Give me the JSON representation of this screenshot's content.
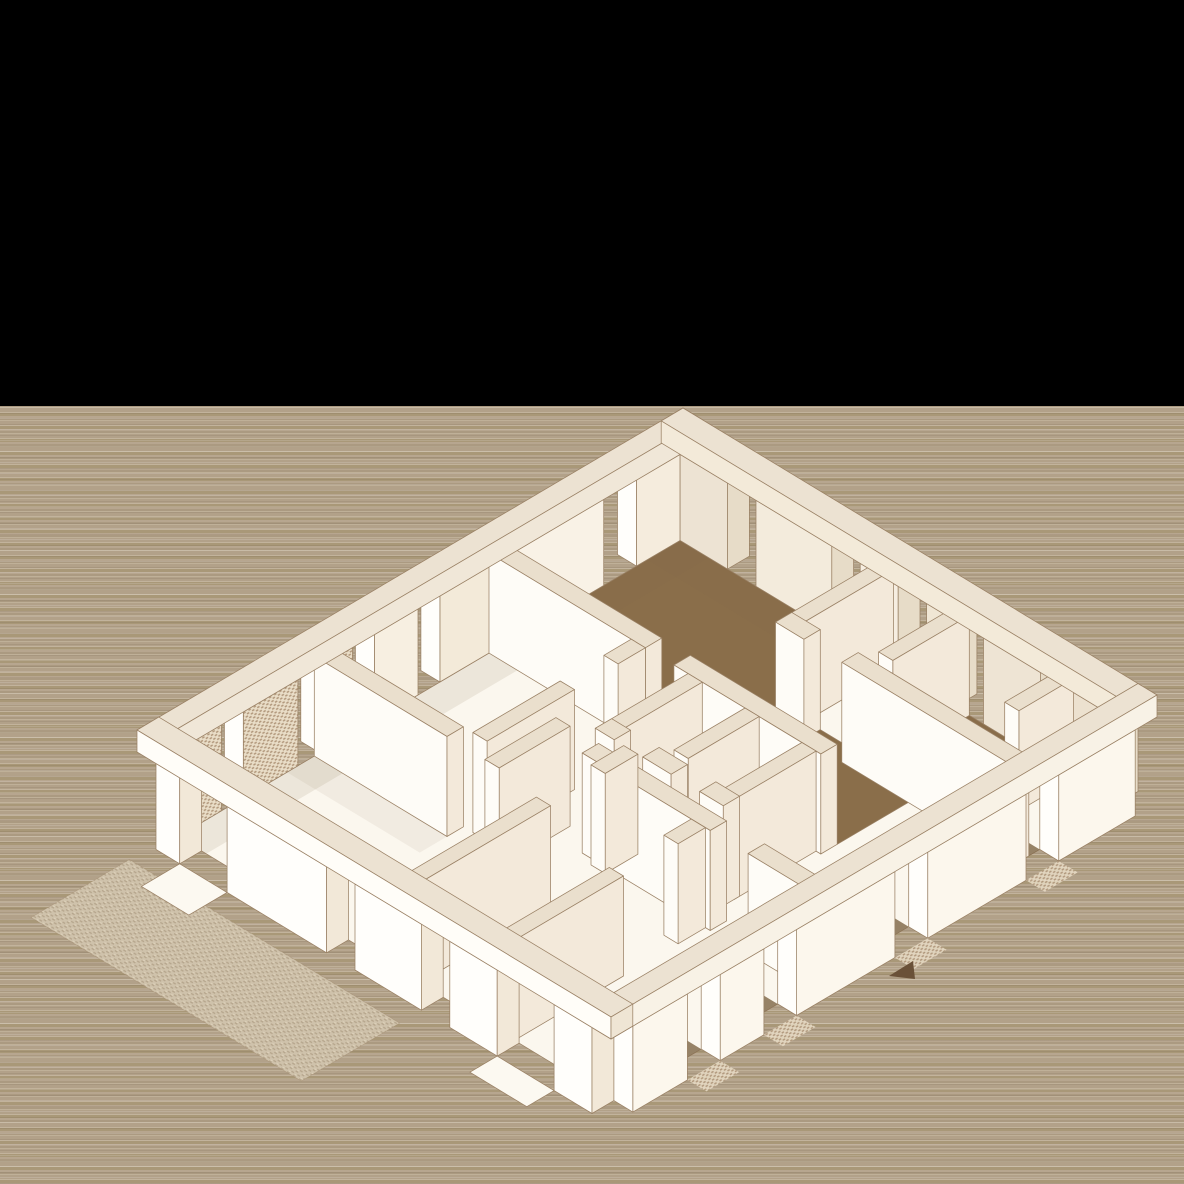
{
  "scene": {
    "kind": "axonometric-floor-plan",
    "elements": [
      "black-top-band",
      "striped-background",
      "floor-plan-drawing",
      "patio-texture",
      "hall-floor",
      "room-floors",
      "outer-wall-rim",
      "window-openings",
      "brick-textured-piers",
      "door-thresholds",
      "direction-marker"
    ]
  },
  "colors": {
    "black_band": "#000000",
    "background_tan": "#b2a189",
    "background_stripe_light": "#c2b39c",
    "background_stripe_dark": "#a99878",
    "line": "#9a8165",
    "wall_top": "#eadfcd",
    "rim_top": "#ece2d2",
    "rim_inner_nw": "#f0e7d8",
    "rim_inner_ne": "#f3ead9",
    "rim_outer_sw": "#fffdf8",
    "rim_outer_se": "#f8f2e6",
    "rim_cap": "#efe5d4",
    "white": "#fffefb",
    "wall_face_sw": "#fefcf7",
    "wall_cream": "#f3e9da",
    "wall_cream2": "#f3e9da",
    "facade_inner_ne": "#ede3d3",
    "facade_inner_nw": "#f5ecdd",
    "facade_outer_se": "#fcf7ed",
    "floor_white": "#fbf7ee",
    "floor_brown": "#8a6e4a",
    "shadow_dark": "#7d6444",
    "shadow_soft": "#836c49",
    "patio_base": "#cfc2ab",
    "patio_dot": "#b5a58c",
    "patio_light": "#ded2bb",
    "brick_bg": "#e9ddc7",
    "brick_dot": "#b1977b",
    "threshold": "#fcf9f1",
    "marker": "#6a5138"
  }
}
